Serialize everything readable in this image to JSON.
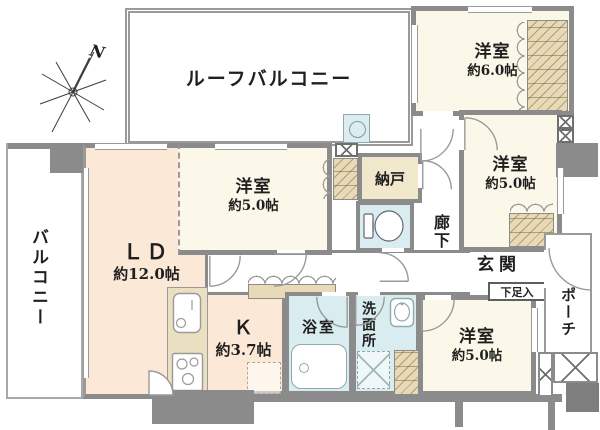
{
  "plan": {
    "compass": {
      "label": "N"
    },
    "rooms": {
      "roof_balcony": {
        "name": "ルーフバルコニー"
      },
      "balcony": {
        "name": "バルコニー"
      },
      "porch": {
        "name": "ポーチ"
      },
      "bedroom_ne": {
        "name": "洋室",
        "area": "約6.0帖"
      },
      "bedroom_e": {
        "name": "洋室",
        "area": "約5.0帖"
      },
      "bedroom_c": {
        "name": "洋室",
        "area": "約5.0帖"
      },
      "bedroom_se": {
        "name": "洋室",
        "area": "約5.0帖"
      },
      "living_dining": {
        "name": "ＬＤ",
        "area": "約12.0帖"
      },
      "kitchen": {
        "name": "Ｋ",
        "area": "約3.7帖"
      },
      "bathroom": {
        "name": "浴室"
      },
      "washroom": {
        "name": "洗面所"
      },
      "storage_room": {
        "name": "納戸"
      },
      "hallway": {
        "name": "廊下"
      },
      "entrance": {
        "name": "玄関"
      },
      "shoe_cabinet": {
        "name": "下足入"
      }
    },
    "colors": {
      "wall": "#8b8b8b",
      "western_room": "#fbf8e9",
      "living_kitchen": "#fce8d7",
      "wet_area": "#d9ecef",
      "closet": "#e8dab6",
      "background": "#ffffff"
    },
    "icons": {
      "compass": "compass-north-icon",
      "toilet": "toilet-icon",
      "bathtub": "bathtub-icon",
      "washbasin": "washbasin-icon",
      "kitchen_sink": "kitchen-sink-icon",
      "stove": "stove-icon",
      "washing_machine": "washing-machine-icon",
      "slop_sink": "slop-sink-icon",
      "pipe_space": "pipe-space-icon"
    }
  }
}
